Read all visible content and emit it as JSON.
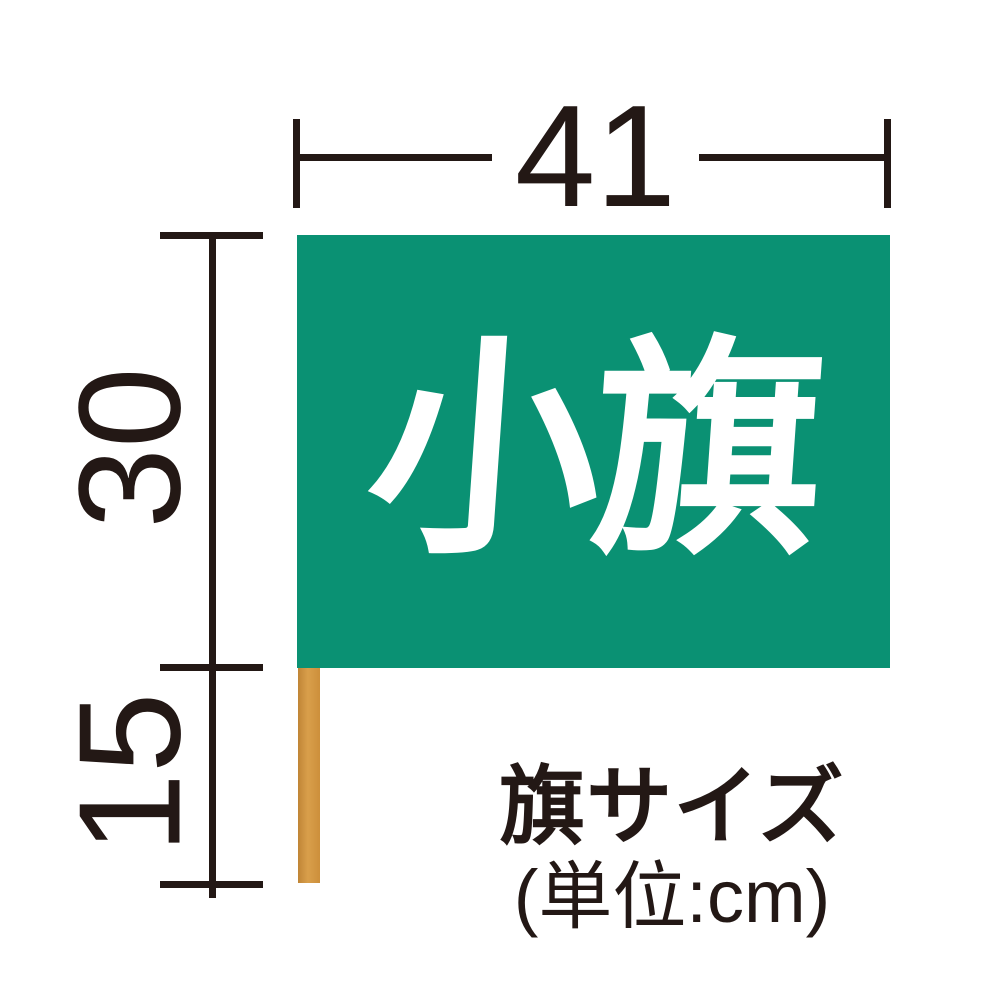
{
  "diagram": {
    "flag_label": "小旗",
    "dimensions": {
      "width": {
        "value": "41"
      },
      "flag_height": {
        "value": "30"
      },
      "pole_below": {
        "value": "15"
      }
    },
    "caption": {
      "title": "旗サイズ",
      "unit_note": "(単位:cm)"
    },
    "colors": {
      "flag_green": "#0a9173",
      "pole_tan": "#d2943e",
      "ink": "#231815",
      "flag_text": "#ffffff",
      "background": "#ffffff"
    }
  }
}
